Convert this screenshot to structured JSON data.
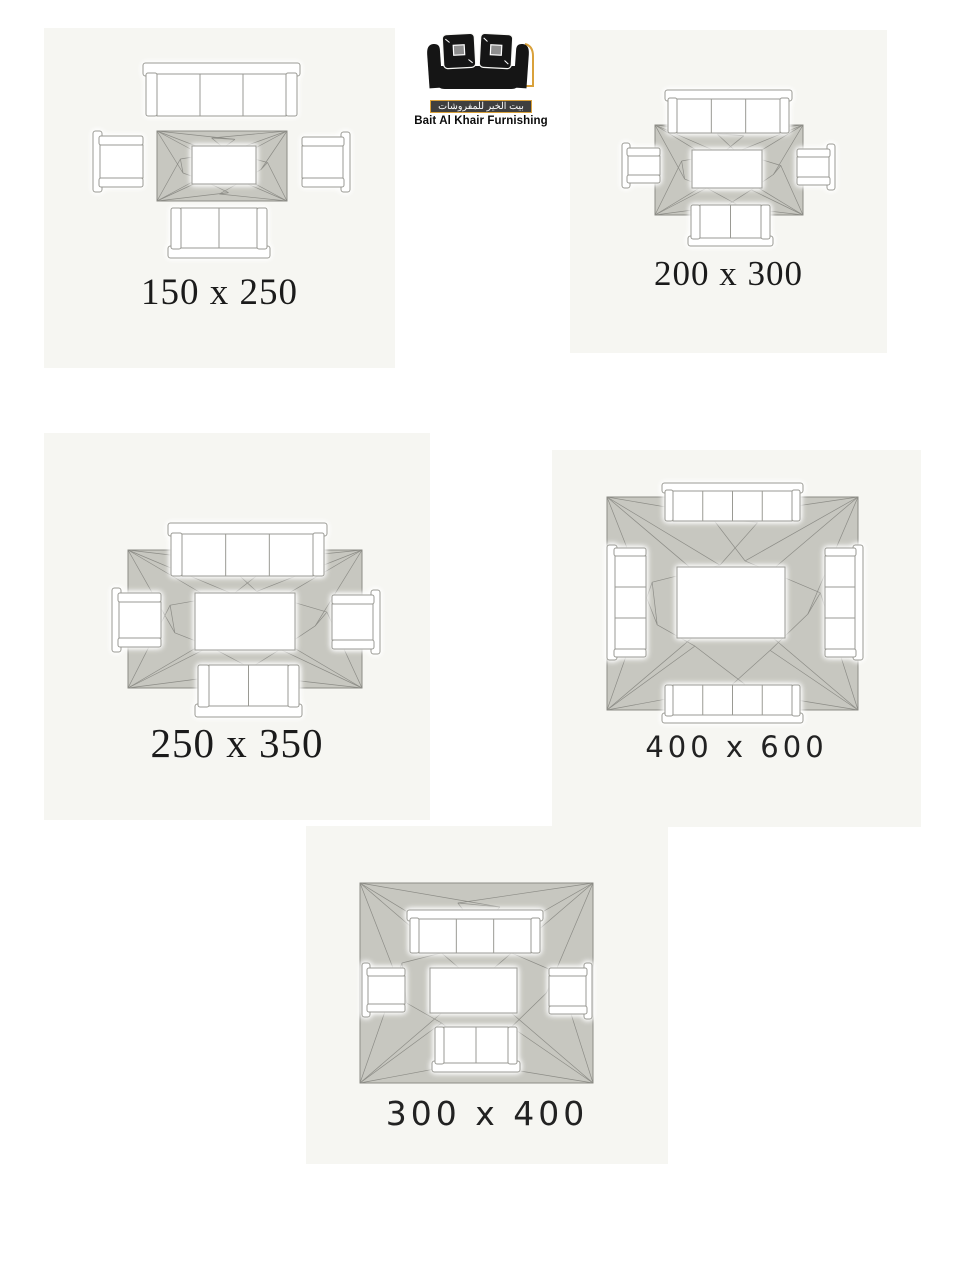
{
  "brand": {
    "name_english": "Bait Al Khair Furnishing",
    "name_arabic": "بيت الخير للمفروشات",
    "logo_black": "#151515",
    "logo_gold": "#d9a13b",
    "logo_bar_bg": "#3f3f3f",
    "logo_bar_text": "#ffffff"
  },
  "panels": [
    {
      "id": "rug-150x250",
      "label": "150 x 250",
      "width_cm": 150,
      "length_cm": 250,
      "label_font": "serif"
    },
    {
      "id": "rug-200x300",
      "label": "200 x 300",
      "width_cm": 200,
      "length_cm": 300,
      "label_font": "serif"
    },
    {
      "id": "rug-250x350",
      "label": "250 x 350",
      "width_cm": 250,
      "length_cm": 350,
      "label_font": "serif"
    },
    {
      "id": "rug-400x600",
      "label": "400 x 600",
      "width_cm": 400,
      "length_cm": 600,
      "label_font": "geometric"
    },
    {
      "id": "rug-300x400",
      "label": "300 x 400",
      "width_cm": 300,
      "length_cm": 400,
      "label_font": "geometric"
    }
  ],
  "colors": {
    "page_bg": "#ffffff",
    "panel_bg": "#f6f6f2",
    "rug_fill": "#c7c7c0",
    "rug_line": "#8c8c86",
    "furniture_fill": "#ffffff",
    "furniture_stroke": "#9a9a94",
    "label_text": "#1b1b1b"
  }
}
